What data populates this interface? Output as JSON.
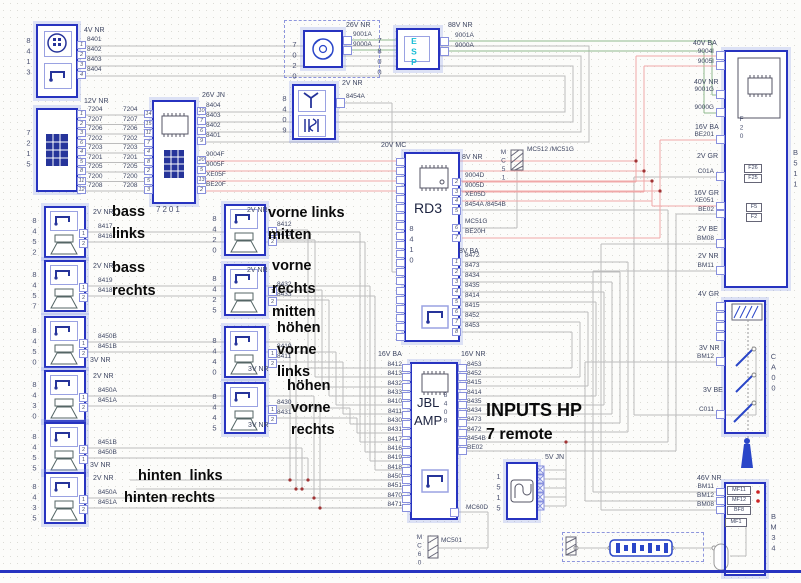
{
  "diagram": {
    "blocks": {
      "b8413": {
        "id": "8413",
        "connector": "4V NR",
        "pins": [
          "1",
          "2",
          "3",
          "4"
        ],
        "wires": [
          "8401",
          "8402",
          "8403",
          "8404"
        ]
      },
      "b7215": {
        "id": "7215",
        "connector": "12V NR",
        "pins": [
          "1",
          "2",
          "3",
          "6",
          "4",
          "5",
          "8",
          "11",
          "12"
        ],
        "wires": [
          "7204",
          "7207",
          "7206",
          "7202",
          "7203",
          "7201",
          "7205",
          "7200",
          "7208"
        ]
      },
      "b7201": {
        "id": "7201",
        "connector_right": "26V JN",
        "pins_left": [
          "14",
          "15",
          "11",
          "7",
          "4",
          "8",
          "2",
          "5",
          "3"
        ],
        "pins_right_gray": [
          "10",
          "7",
          "6",
          "9"
        ],
        "pins_right_red": [
          "20",
          "5",
          "13",
          "2"
        ],
        "wires_gray": [
          "8404",
          "8403",
          "8402",
          "8401"
        ],
        "wires_red": [
          "9004F",
          "9005F",
          "XE05F",
          "BE20F"
        ]
      },
      "b7020": {
        "id": "7020",
        "connector": "26V NR",
        "wires": [
          "9001A",
          "9000A"
        ]
      },
      "b7800": {
        "id": "7800",
        "label": "ESP",
        "connector": "88V NR",
        "wires": [
          "9001A",
          "9000A"
        ]
      },
      "b8409": {
        "id": "8409",
        "connector": "2V NR",
        "wire": "8454A"
      },
      "rd3": {
        "name": "RD3",
        "id": "8410",
        "connector_left": "20V MC",
        "connector_right_top": "8V NR",
        "connector_right_bottom": "8V BA",
        "ground": "MC51",
        "ground_label": "MC512 /MC51G",
        "pins_top": [
          "2",
          "3",
          "4",
          "5"
        ],
        "wires_top": [
          "9004D",
          "9005D",
          "XE05D",
          "8454A /8454B"
        ],
        "pins_top2": [
          "6",
          "7"
        ],
        "wires_top2": [
          "MC51G",
          "BE20H"
        ],
        "pins_bottom": [
          "1",
          "2",
          "3",
          "4",
          "5",
          "6",
          "7",
          "8"
        ],
        "wires_bottom": [
          "8472",
          "8473",
          "8434",
          "8435",
          "8414",
          "8415",
          "8452",
          "8453"
        ]
      },
      "amp": {
        "name1": "JBL",
        "name2": "AMP",
        "id": "8408",
        "connector_left": "16V BA",
        "connector_right": "16V NR",
        "wires_left": [
          "8412",
          "8413",
          "8432",
          "8433",
          "8410",
          "8411",
          "8430",
          "8431",
          "8417",
          "8416",
          "8419",
          "8418",
          "8450",
          "8451",
          "8470",
          "8471"
        ],
        "wires_right": [
          "8453",
          "8452",
          "8415",
          "8414",
          "8435",
          "8434",
          "8473",
          "8472",
          "8454B",
          "BE02"
        ],
        "wire_bottom": "MC60D",
        "ground": "MC60",
        "ground_wire": "MC501"
      },
      "b1515": {
        "id": "1515",
        "connector": "5V JN"
      },
      "b511": {
        "id": "B511",
        "fuse_f20": "F20",
        "fuse_f26": "F26",
        "fuse_f25": "F25",
        "fuse_f5": "F5",
        "fuse_f2": "F2",
        "groups": [
          {
            "conn": "40V BA",
            "wires": [
              "9004I",
              "9005I"
            ]
          },
          {
            "conn": "40V NR",
            "wires": [
              "9001G",
              "9000G"
            ]
          },
          {
            "conn": "16V BA",
            "wires": [
              "BE201"
            ]
          },
          {
            "conn": "2V GR",
            "wires": [
              "C01A"
            ]
          },
          {
            "conn": "16V GR",
            "wires": [
              "XE051",
              "BE02"
            ]
          },
          {
            "conn": "2V BE",
            "wires": [
              "BM08"
            ]
          },
          {
            "conn": "2V NR",
            "wires": [
              "BM11"
            ]
          }
        ]
      },
      "ca00": {
        "id": "CA00",
        "conn_top": "4V GR",
        "conn_mid": "3V NR",
        "wire_mid": "BM12",
        "conn_bot": "3V BE",
        "wire_bot": "C011"
      },
      "bm34": {
        "id": "BM34",
        "connector": "46V NR",
        "wires": [
          "BM11",
          "BM12",
          "BM08"
        ],
        "fuses": [
          "MF11",
          "MF12",
          "BF8",
          "MF1"
        ]
      }
    },
    "speakers_left": [
      {
        "id": "8452",
        "conn": "2V NR",
        "wires": [
          "8417",
          "8416"
        ],
        "pins": [
          "1",
          "2"
        ]
      },
      {
        "id": "8457",
        "conn": "2V NR",
        "wires": [
          "8419",
          "8418"
        ],
        "pins": [
          "1",
          "2"
        ]
      },
      {
        "id": "8450",
        "conn": "3V NR",
        "wires": [
          "8450B",
          "8451B"
        ],
        "pins": [
          "1",
          "2"
        ]
      },
      {
        "id": "8430",
        "conn": "2V NR",
        "wires": [
          "8450A",
          "8451A"
        ],
        "pins": [
          "1",
          "2"
        ]
      },
      {
        "id": "8455",
        "conn": "3V NR",
        "wires": [
          "8451B",
          "8450B"
        ],
        "pins": [
          "2",
          "1"
        ]
      },
      {
        "id": "8435",
        "conn": "2V NR",
        "wires": [
          "8450A",
          "8451A"
        ],
        "pins": [
          "1",
          "2"
        ]
      }
    ],
    "speakers_mid": [
      {
        "id": "8420",
        "conn": "2V NR",
        "wires": [
          "8412",
          "8413"
        ],
        "pins": [
          "1",
          "2"
        ]
      },
      {
        "id": "8425",
        "conn": "2V NR",
        "wires": [
          "8432",
          "8433"
        ],
        "pins": [
          "1",
          "2"
        ]
      },
      {
        "id": "8440",
        "conn": "3V NR",
        "wires": [
          "8410",
          "8411"
        ],
        "pins": [
          "1",
          "2"
        ]
      },
      {
        "id": "8445",
        "conn": "3V NR",
        "wires": [
          "8430",
          "8431"
        ],
        "pins": [
          "1",
          "2"
        ]
      }
    ],
    "annotations": {
      "bass_l1": "bass",
      "bass_l2": "links",
      "bass_r1": "bass",
      "bass_r2": "rechts",
      "vl1": "vorne links",
      "vl2": "mitten",
      "vr1": "vorne",
      "vr2": "rechts",
      "vr3": "mitten",
      "hoel1": "höhen",
      "hoel2": "vorne",
      "hoel3": "links",
      "hoer1": "höhen",
      "hoer2": "vorne",
      "hoer3": "rechts",
      "hint_l": "hinten  links",
      "hint_r": "hinten rechts",
      "inputs": "INPUTS HP",
      "remote": "7 remote"
    }
  }
}
